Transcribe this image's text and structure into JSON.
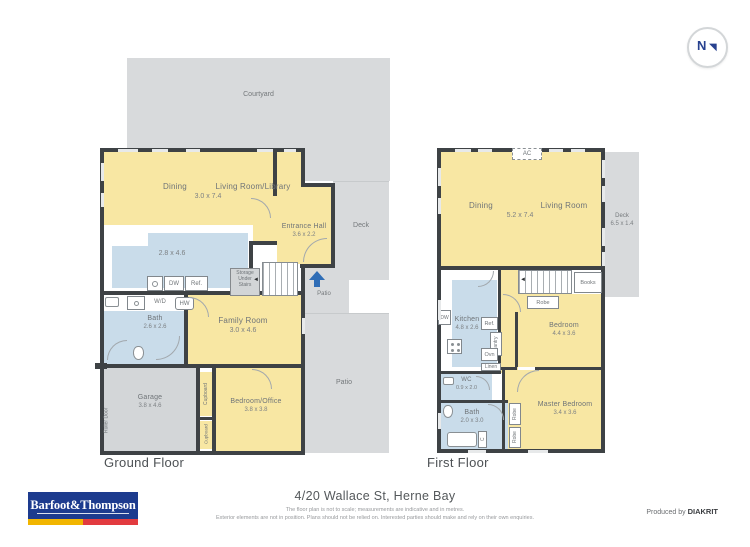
{
  "colors": {
    "room_yellow": "#f8e7a3",
    "wet_blue": "#c9dcea",
    "outdoor_grey": "#d8dadc",
    "outdoor_grey_dark": "#d3d6d8",
    "wall_dark": "#3e4245",
    "entry_arrow_blue": "#2f6db6",
    "brand_blue": "#1d3b8e",
    "stripe_gold": "#f1b500",
    "stripe_red": "#e23b3f",
    "compass_navy": "#27418f"
  },
  "compass": {
    "north_label": "N"
  },
  "ground": {
    "floor_label": "Ground Floor",
    "courtyard_label": "Courtyard",
    "deck_label": "Deck",
    "patio_entry_label": "Patio",
    "patio_main_label": "Patio",
    "dining_label": "Dining",
    "living_label": "Living Room/Library",
    "living_dims": "3.0 x 7.4",
    "entrance_label": "Entrance Hall",
    "entrance_dims": "3.6 x 2.2",
    "kitchen_dims": "2.8 x 4.6",
    "storage_label": "Storage\nUnder\nStairs",
    "dw_label": "DW",
    "ref_label": "Ref.",
    "wd_label": "W/D",
    "hw_label": "HW",
    "bath_label": "Bath",
    "bath_dims": "2.6 x 2.6",
    "family_label": "Family Room",
    "family_dims": "3.0 x 4.6",
    "garage_label": "Garage",
    "garage_dims": "3.8 x 4.6",
    "roller_door_label": "Roller Door",
    "cupboard_a_label": "Cupboard",
    "cupboard_b_label": "Cupboard",
    "bedroom_office_label": "Bedroom/Office",
    "bedroom_office_dims": "3.8 x 3.8"
  },
  "first": {
    "floor_label": "First Floor",
    "ac_label": "AC",
    "dining_label": "Dining",
    "living_label": "Living Room",
    "living_dims": "5.2 x 7.4",
    "deck_label": "Deck",
    "deck_dims": "6.5 x 1.4",
    "books_label": "Books",
    "robe_hall_label": "Robe",
    "kitchen_label": "Kitchen",
    "kitchen_dims": "4.8 x 2.6",
    "dw_label": "DW",
    "ref_label": "Ref.",
    "pantry_label": "Pantry",
    "ovn_label": "Ovn",
    "linen_label": "Linen",
    "bedroom_label": "Bedroom",
    "bedroom_dims": "4.4 x 3.6",
    "master_label": "Master Bedroom",
    "master_dims": "3.4 x 3.6",
    "wc_label": "WC",
    "wc_dims": "0.9 x 2.0",
    "bath_label": "Bath",
    "bath_dims": "2.0 x 3.0",
    "robe_a_label": "Robe",
    "robe_b_label": "Robe",
    "cupboard_label": "C"
  },
  "footer": {
    "brand_name": "Barfoot&Thompson",
    "address": "4/20 Wallace St, Herne Bay",
    "disclaimer_line1": "The floor plan is not to scale; measurements are indicative and in metres.",
    "disclaimer_line2": "Exterior elements are not in position. Plans should not be relied on. Interested parties should make and rely on their own enquiries.",
    "produced_by_label": "Produced by",
    "producer_name": "DIAKRIT"
  }
}
